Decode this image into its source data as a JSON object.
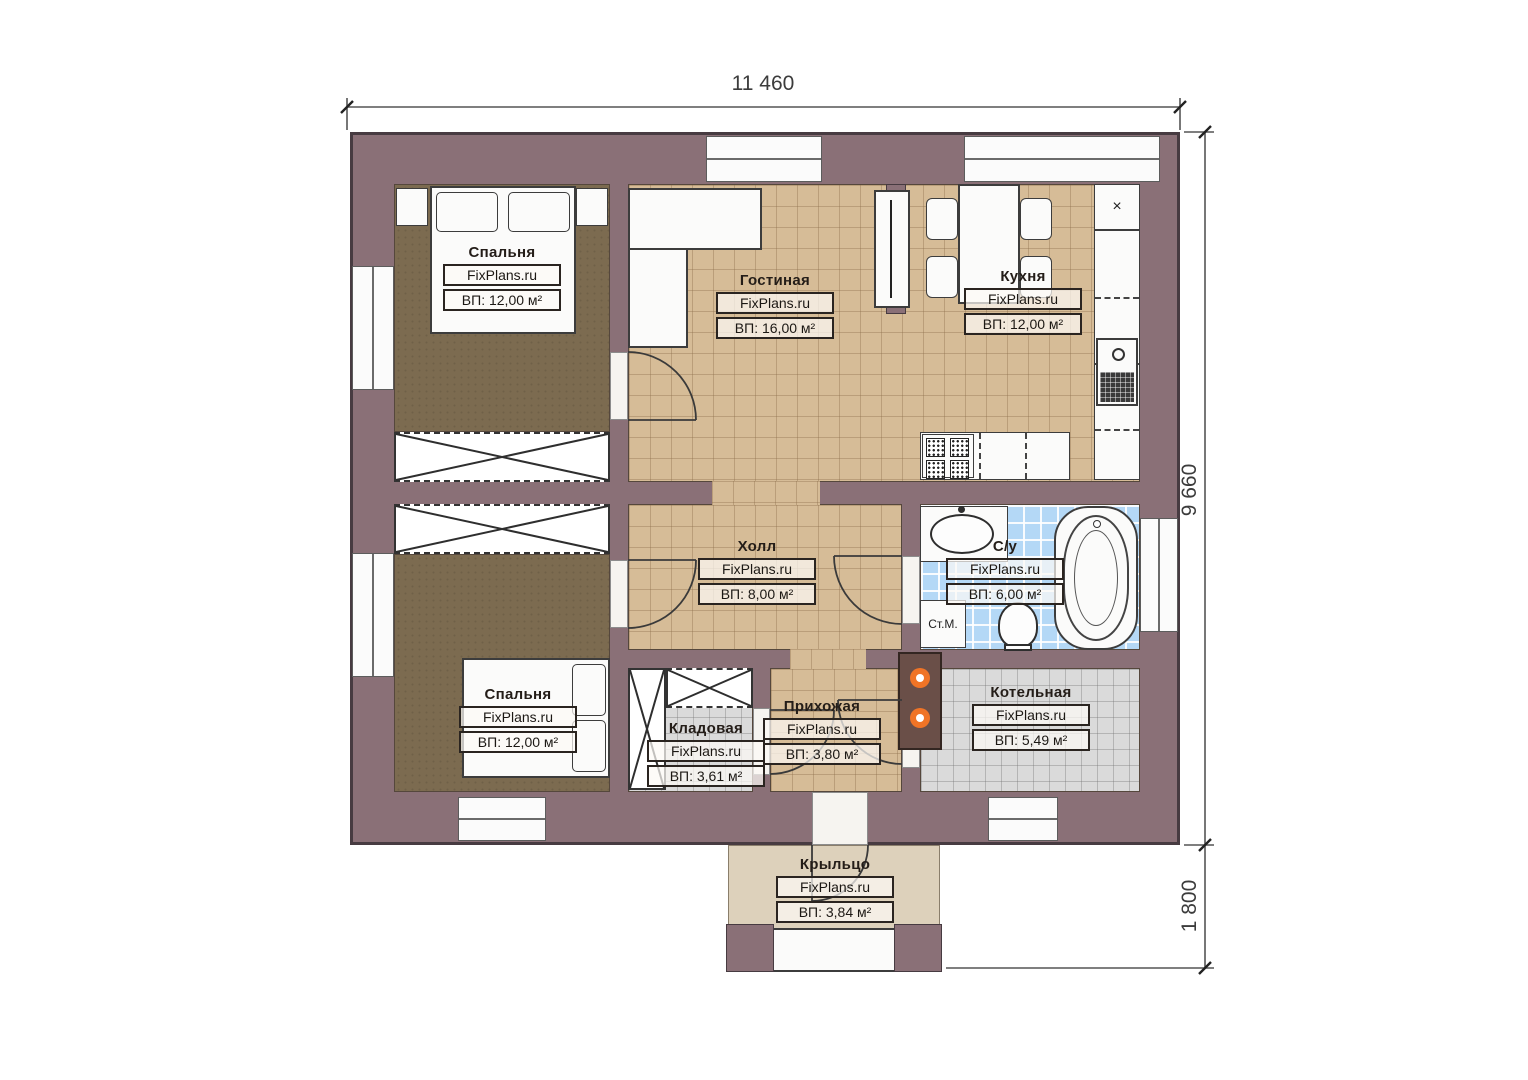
{
  "brand": "FixPlans.ru",
  "dimensions": {
    "total_width": "11 460",
    "total_height": "9 660",
    "porch_depth": "1 800"
  },
  "rooms": [
    {
      "id": "bedroom-1",
      "name": "Спальня",
      "area": "ВП: 12,00 м²"
    },
    {
      "id": "living-room",
      "name": "Гостиная",
      "area": "ВП: 16,00 м²"
    },
    {
      "id": "kitchen",
      "name": "Кухня",
      "area": "ВП: 12,00 м²"
    },
    {
      "id": "hall",
      "name": "Холл",
      "area": "ВП: 8,00 м²"
    },
    {
      "id": "bathroom",
      "name": "С/у",
      "area": "ВП: 6,00 м²"
    },
    {
      "id": "bedroom-2",
      "name": "Спальня",
      "area": "ВП: 12,00 м²"
    },
    {
      "id": "storage",
      "name": "Кладовая",
      "area": "ВП: 3,61 м²"
    },
    {
      "id": "entryway",
      "name": "Прихожая",
      "area": "ВП: 3,80 м²"
    },
    {
      "id": "boiler-room",
      "name": "Котельная",
      "area": "ВП: 5,49 м²"
    },
    {
      "id": "porch",
      "name": "Крыльцо",
      "area": "ВП: 3,84 м²"
    }
  ],
  "annotations": {
    "washing_machine": "Ст.М.",
    "vent_symbol": "×"
  },
  "colors": {
    "wall": "#8a7077",
    "wall_outline": "#473b41",
    "floor_bedroom": "#7c6b50",
    "floor_tile": "#d6bc97",
    "floor_bath": "#b4d8f6",
    "floor_tech": "#dadada",
    "floor_porch": "#ddd1bb",
    "boiler_flame": "#f07426"
  }
}
